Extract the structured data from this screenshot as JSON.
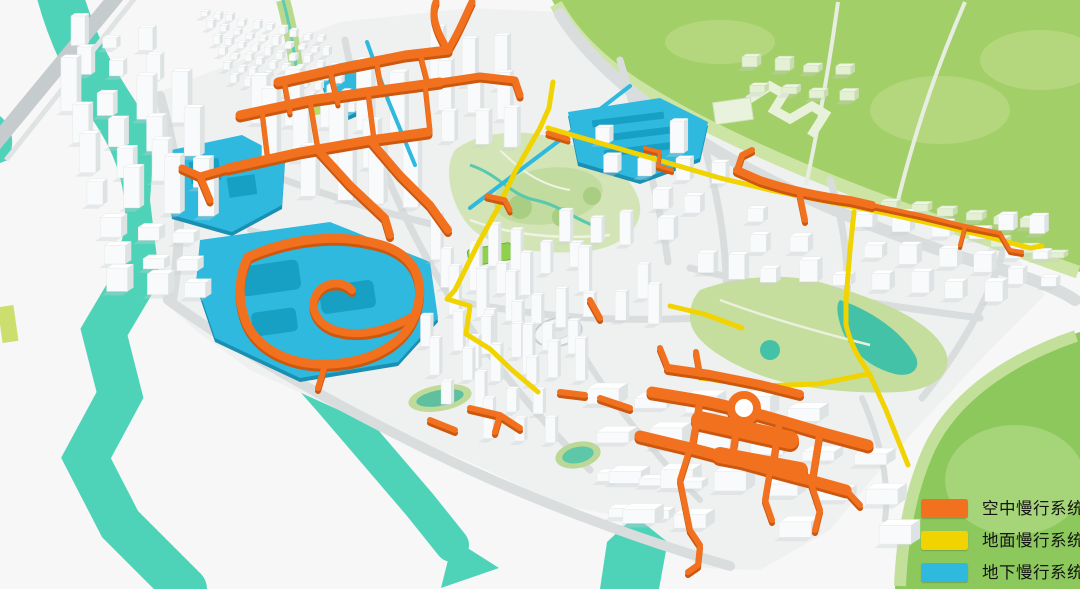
{
  "title": "慢行系统规划图",
  "legend": {
    "items": [
      {
        "id": "aerial",
        "label": "空中慢行系统",
        "color": "#F2711F"
      },
      {
        "id": "ground",
        "label": "地面慢行系统",
        "color": "#F0D300"
      },
      {
        "id": "underground",
        "label": "地下慢行系统",
        "color": "#2FB9DE"
      }
    ]
  },
  "map": {
    "palette": {
      "background": "#f6f7f6",
      "river_teal": "#4fd3b8",
      "hill_green": "#a3cf68",
      "hill_green_light": "#cde5a4",
      "park_green": "#d3e5b7",
      "building_white": "#fafbfb",
      "road_gray": "#d9dddd",
      "aerial_orange": "#F2711F",
      "ground_yellow": "#F0D300",
      "underground_cyan": "#2FB9DE"
    },
    "features": {
      "river": "river",
      "northeast-hill": "green hill park",
      "southeast-hill": "green hill park",
      "central-park": "central park",
      "city": "white building massing"
    }
  }
}
